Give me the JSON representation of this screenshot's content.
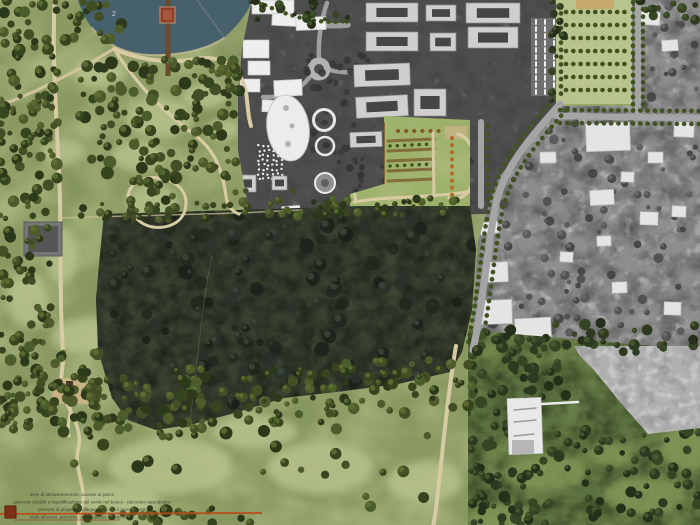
{
  "map": {
    "type": "landscape-masterplan-aerial-photomontage",
    "annotations": {
      "lake_label": "2"
    },
    "legend": {
      "lines": [
        "aree di attraversamento, accessi al parco",
        "percorsi ciclabili e riqualificazione del verde nel bosco - percorso naturalistico",
        "percorsi di progetto, collegamento con il parco esistente",
        "viale alberato, percorso ciclopedonale esistente"
      ],
      "route_color": "#b84e1a",
      "marker_color": "#7e3018"
    },
    "palette": {
      "park-base": "#8a9a62",
      "meadow": "#b6c18c",
      "lake": "#46616d",
      "shore": "#cabc94",
      "path": "#d8cba4",
      "path2": "#cfc39b",
      "pier": "#6b4a2f",
      "hut": "#8a4028",
      "forest": "#39402f",
      "campus": "#4e4e4e",
      "town": "#8d8d8d",
      "building-light": "#cfcfcf",
      "building-inner": "#454545",
      "orchard": "#b9c48e",
      "orchard-tan": "#c9a96b",
      "garden-lawn": "#9cb169",
      "garden-brown": "#7d6134",
      "garden-orange": "#b26a28",
      "road-gray": "#a5a5a5",
      "street-tree": "#3f5220",
      "gray-forest": "#b0b0b0",
      "overlay-green": "#5c7140",
      "overlay-light": "#849a58",
      "route-orange": "#b84e1a",
      "legend-red": "#7e3018",
      "legend-text": "#2c301d",
      "label": "#dfe3e4"
    }
  },
  "features": {
    "tree_clusters": [
      {
        "layer": "trees-park",
        "x": 0,
        "y": 0,
        "w": 58,
        "h": 185,
        "n": 85,
        "r1": 2.5,
        "r2": 6,
        "seed": 1,
        "colors": [
          "#2c381a",
          "#37451f",
          "#424f25",
          "#4d5c2b"
        ],
        "hi": "#5f7034"
      },
      {
        "layer": "trees-park",
        "x": 0,
        "y": 185,
        "w": 52,
        "h": 170,
        "n": 60,
        "r1": 2.5,
        "r2": 6,
        "seed": 2,
        "colors": [
          "#2c381a",
          "#37451f",
          "#424f25",
          "#4d5c2b"
        ],
        "hi": "#5f7034"
      },
      {
        "layer": "trees-park",
        "x": 0,
        "y": 352,
        "w": 52,
        "h": 85,
        "n": 26,
        "r1": 2.5,
        "r2": 6,
        "seed": 3,
        "colors": [
          "#2c381a",
          "#37451f",
          "#424f25",
          "#4d5c2b"
        ],
        "hi": "#5f7034"
      },
      {
        "layer": "trees-park",
        "x": 80,
        "y": 58,
        "w": 158,
        "h": 122,
        "n": 115,
        "r1": 2.5,
        "r2": 6.5,
        "seed": 4,
        "colors": [
          "#2c381a",
          "#37451f",
          "#424f25",
          "#4d5c2b"
        ],
        "hi": "#5f7034"
      },
      {
        "layer": "trees-park",
        "x": 130,
        "y": 178,
        "w": 46,
        "h": 46,
        "n": 22,
        "r1": 2.5,
        "r2": 5.5,
        "seed": 5,
        "colors": [
          "#2c381a",
          "#37451f",
          "#424f25",
          "#4d5c2b"
        ],
        "hi": "#5f7034"
      },
      {
        "layer": "trees-park",
        "x": 36,
        "y": 352,
        "w": 64,
        "h": 52,
        "n": 30,
        "r1": 2.5,
        "r2": 6,
        "seed": 6,
        "colors": [
          "#2c381a",
          "#37451f",
          "#424f25",
          "#4d5c2b"
        ],
        "hi": "#5f7034"
      },
      {
        "layer": "trees-park",
        "x": 92,
        "y": 378,
        "w": 46,
        "h": 44,
        "n": 16,
        "r1": 2.5,
        "r2": 5.5,
        "seed": 7,
        "colors": [
          "#2c381a",
          "#37451f",
          "#424f25",
          "#4d5c2b"
        ],
        "hi": "#5f7034"
      },
      {
        "layer": "trees-park",
        "x": 0,
        "y": 375,
        "w": 205,
        "h": 62,
        "n": 75,
        "r1": 2.5,
        "r2": 6,
        "seed": 8,
        "colors": [
          "#2c381a",
          "#37451f",
          "#424f25",
          "#4d5c2b"
        ],
        "hi": "#5f7034"
      },
      {
        "layer": "trees-park",
        "x": 175,
        "y": 368,
        "w": 160,
        "h": 55,
        "n": 60,
        "r1": 2.5,
        "r2": 6,
        "seed": 9,
        "colors": [
          "#2c381a",
          "#37451f",
          "#424f25",
          "#4d5c2b"
        ],
        "hi": "#5f7034"
      },
      {
        "layer": "trees-park",
        "x": 325,
        "y": 360,
        "w": 148,
        "h": 54,
        "n": 52,
        "r1": 2.5,
        "r2": 6,
        "seed": 10,
        "colors": [
          "#2c381a",
          "#37451f",
          "#424f25",
          "#4d5c2b"
        ],
        "hi": "#5f7034"
      },
      {
        "layer": "trees-park",
        "x": 230,
        "y": 190,
        "w": 115,
        "h": 28,
        "n": 30,
        "r1": 2,
        "r2": 5,
        "seed": 11,
        "colors": [
          "#2c381a",
          "#37451f",
          "#424f25",
          "#4d5c2b"
        ],
        "hi": "#5f7034"
      },
      {
        "layer": "trees-park",
        "x": 340,
        "y": 198,
        "w": 132,
        "h": 18,
        "n": 24,
        "r1": 2,
        "r2": 4.5,
        "seed": 12,
        "colors": [
          "#2c381a",
          "#37451f",
          "#424f25",
          "#4d5c2b"
        ],
        "hi": "#5f7034"
      },
      {
        "layer": "trees-park",
        "x": 60,
        "y": 203,
        "w": 178,
        "h": 16,
        "n": 24,
        "r1": 2,
        "r2": 4.5,
        "seed": 13,
        "colors": [
          "#2c381a",
          "#37451f",
          "#424f25",
          "#4d5c2b"
        ],
        "hi": "#5f7034"
      },
      {
        "layer": "trees-park",
        "x": 60,
        "y": 0,
        "w": 62,
        "h": 44,
        "n": 18,
        "r1": 2.5,
        "r2": 6,
        "seed": 14,
        "colors": [
          "#2c381a",
          "#37451f",
          "#424f25",
          "#4d5c2b"
        ],
        "hi": "#5f7034"
      },
      {
        "layer": "trees-park",
        "x": 248,
        "y": 0,
        "w": 100,
        "h": 27,
        "n": 22,
        "r1": 2,
        "r2": 5,
        "seed": 15,
        "colors": [
          "#24301a",
          "#2d3a1f",
          "#364524"
        ],
        "hi": "#495930"
      },
      {
        "layer": "trees-park",
        "x": 550,
        "y": 0,
        "w": 14,
        "h": 106,
        "n": 15,
        "r1": 2,
        "r2": 4.5,
        "seed": 16,
        "colors": [
          "#24301a",
          "#2d3a1f",
          "#364524"
        ],
        "hi": "#495930"
      },
      {
        "layer": "trees-park",
        "x": 466,
        "y": 322,
        "w": 238,
        "h": 34,
        "n": 44,
        "r1": 2.5,
        "r2": 6,
        "seed": 17,
        "colors": [
          "#24301a",
          "#2d3a1f",
          "#364524"
        ],
        "hi": "#495930"
      },
      {
        "layer": "trees-park",
        "x": 640,
        "y": 0,
        "w": 60,
        "h": 20,
        "n": 12,
        "r1": 2.5,
        "r2": 5.5,
        "seed": 18,
        "colors": [
          "#24301a",
          "#2d3a1f",
          "#364524"
        ],
        "hi": "#495930"
      },
      {
        "layer": "trees-park",
        "x": 196,
        "y": 58,
        "w": 46,
        "h": 42,
        "n": 16,
        "r1": 2.5,
        "r2": 6,
        "seed": 19,
        "colors": [
          "#2c381a",
          "#37451f",
          "#424f25",
          "#4d5c2b"
        ],
        "hi": "#5f7034"
      },
      {
        "layer": "trees-park",
        "x": 60,
        "y": 428,
        "w": 370,
        "h": 92,
        "n": 26,
        "r1": 3,
        "r2": 6.5,
        "seed": 20,
        "colors": [
          "#2c381a",
          "#37451f",
          "#424f25",
          "#4d5c2b"
        ],
        "hi": "#5f7034"
      },
      {
        "layer": "trees-park",
        "x": 84,
        "y": 508,
        "w": 170,
        "h": 16,
        "n": 24,
        "r1": 2.5,
        "r2": 5,
        "seed": 21,
        "colors": [
          "#2c381a",
          "#37451f",
          "#424f25",
          "#4d5c2b"
        ],
        "hi": "#5f7034"
      },
      {
        "layer": "overlay-detail",
        "x": 468,
        "y": 330,
        "w": 100,
        "h": 70,
        "n": 40,
        "r1": 2.5,
        "r2": 6,
        "seed": 22,
        "colors": [
          "#24301a",
          "#2d3a1f",
          "#364524"
        ],
        "hi": "#495930"
      },
      {
        "layer": "overlay-detail",
        "x": 468,
        "y": 400,
        "w": 70,
        "h": 125,
        "n": 38,
        "r1": 2.5,
        "r2": 6,
        "seed": 23,
        "colors": [
          "#24301a",
          "#2d3a1f",
          "#364524"
        ],
        "hi": "#495930"
      },
      {
        "layer": "overlay-detail",
        "x": 540,
        "y": 428,
        "w": 165,
        "h": 46,
        "n": 30,
        "r1": 2.5,
        "r2": 6,
        "seed": 24,
        "colors": [
          "#24301a",
          "#2d3a1f",
          "#364524"
        ],
        "hi": "#495930"
      },
      {
        "layer": "overlay-detail",
        "x": 560,
        "y": 466,
        "w": 140,
        "h": 58,
        "n": 26,
        "r1": 2.5,
        "r2": 5.5,
        "seed": 25,
        "colors": [
          "#24301a",
          "#2d3a1f",
          "#364524"
        ],
        "hi": "#495930"
      },
      {
        "layer": "overlay-detail",
        "x": 470,
        "y": 452,
        "w": 80,
        "h": 72,
        "n": 24,
        "r1": 2.5,
        "r2": 5.5,
        "seed": 26,
        "colors": [
          "#24301a",
          "#2d3a1f",
          "#364524"
        ],
        "hi": "#495930"
      },
      {
        "layer": "forest-detail",
        "x": 100,
        "y": 208,
        "w": 375,
        "h": 220,
        "n": 150,
        "r1": 3,
        "r2": 8,
        "seed": 27,
        "colors": [
          "#20271e",
          "#191f18",
          "#2a322a"
        ],
        "hi": "#3a463b",
        "op": 0.8
      },
      {
        "layer": "town-detail",
        "x": 466,
        "y": 0,
        "w": 234,
        "h": 118,
        "n": 70,
        "r1": 2,
        "r2": 5,
        "seed": 28,
        "colors": [
          "#4c4c4c",
          "#575757",
          "#414141"
        ],
        "hi": "#6d6d6d",
        "op": 0.9
      },
      {
        "layer": "town-detail",
        "x": 466,
        "y": 118,
        "w": 234,
        "h": 232,
        "n": 110,
        "r1": 2,
        "r2": 5,
        "seed": 29,
        "colors": [
          "#4c4c4c",
          "#575757",
          "#414141"
        ],
        "hi": "#6d6d6d",
        "op": 0.9
      },
      {
        "layer": "campus-detail",
        "x": 292,
        "y": 52,
        "w": 80,
        "h": 118,
        "n": 55,
        "r1": 1.8,
        "r2": 4,
        "seed": 30,
        "colors": [
          "#3a3a3a",
          "#343434"
        ],
        "hi": null,
        "op": 0.9
      },
      {
        "layer": "campus-detail",
        "x": 352,
        "y": 150,
        "w": 122,
        "h": 58,
        "n": 38,
        "r1": 1.8,
        "r2": 4,
        "seed": 31,
        "colors": [
          "#3a3a3a",
          "#343434"
        ],
        "hi": null,
        "op": 0.9
      },
      {
        "layer": "campus-buildings",
        "x": 259,
        "y": 146,
        "n": 0,
        "r1": 1.2,
        "seed": 32,
        "colors": [
          "#ededed"
        ],
        "hi": null,
        "grid": {
          "rows": 8,
          "cols": 6,
          "dx": 4.6,
          "dy": 4.7
        }
      }
    ],
    "rect_groups": [
      {
        "id": "courtyard-buildings",
        "layer": "campus-buildings",
        "fill": "#cfcfcf",
        "stroke": "#8f8f8f",
        "inner": "#454545",
        "items": [
          [
            366,
            3,
            52,
            19,
            0
          ],
          [
            426,
            5,
            30,
            16,
            0
          ],
          [
            366,
            32,
            52,
            19,
            0
          ],
          [
            430,
            33,
            26,
            18,
            0
          ],
          [
            354,
            64,
            56,
            22,
            -2
          ],
          [
            356,
            96,
            52,
            21,
            -3
          ],
          [
            414,
            89,
            32,
            27,
            0
          ],
          [
            413,
            119,
            30,
            22,
            0
          ],
          [
            350,
            132,
            32,
            15,
            -2
          ],
          [
            466,
            3,
            54,
            20,
            0
          ],
          [
            468,
            27,
            50,
            21,
            0
          ],
          [
            236,
            175,
            20,
            17,
            0
          ],
          [
            272,
            176,
            15,
            14,
            0
          ]
        ]
      },
      {
        "id": "palace-shapes",
        "layer": "campus-buildings",
        "fill": "#eeeeee",
        "stroke": "#c4c4c4",
        "inner": null,
        "items": [
          [
            243,
            40,
            26,
            18,
            0
          ],
          [
            248,
            61,
            22,
            14,
            0
          ],
          [
            240,
            79,
            20,
            13,
            0
          ],
          [
            252,
            0,
            42,
            14,
            0
          ],
          [
            272,
            14,
            30,
            12,
            3
          ],
          [
            296,
            17,
            30,
            13,
            -2
          ],
          [
            274,
            80,
            28,
            16,
            -3
          ],
          [
            262,
            100,
            16,
            12,
            2
          ],
          [
            282,
            206,
            18,
            10,
            -4
          ]
        ]
      },
      {
        "id": "town-buildings",
        "layer": "town-buildings",
        "fill": "#e4e4e4",
        "stroke": "#bdbdbd",
        "inner": null,
        "items": [
          [
            586,
            123,
            44,
            28,
            -2
          ],
          [
            640,
            12,
            20,
            13,
            3
          ],
          [
            662,
            40,
            16,
            11,
            -4
          ],
          [
            674,
            122,
            20,
            15,
            2
          ],
          [
            648,
            152,
            15,
            11,
            0
          ],
          [
            590,
            190,
            24,
            15,
            -3
          ],
          [
            640,
            212,
            18,
            13,
            2
          ],
          [
            478,
            300,
            34,
            24,
            -2
          ],
          [
            515,
            318,
            36,
            19,
            -3
          ],
          [
            488,
            262,
            20,
            20,
            -2
          ],
          [
            560,
            252,
            13,
            10,
            3
          ],
          [
            612,
            282,
            15,
            11,
            -2
          ],
          [
            664,
            302,
            17,
            13,
            2
          ],
          [
            540,
            152,
            16,
            11,
            -1
          ],
          [
            621,
            172,
            13,
            10,
            2
          ],
          [
            597,
            236,
            14,
            10,
            -2
          ],
          [
            672,
            206,
            14,
            11,
            3
          ],
          [
            480,
            222,
            18,
            12,
            -8
          ]
        ]
      },
      {
        "id": "ruin-building",
        "layer": "ruin-layer",
        "fill": "#e8e8e8",
        "stroke": "#bbbbbb",
        "inner": null,
        "items": [
          [
            508,
            398,
            34,
            56,
            -2
          ]
        ]
      }
    ]
  }
}
